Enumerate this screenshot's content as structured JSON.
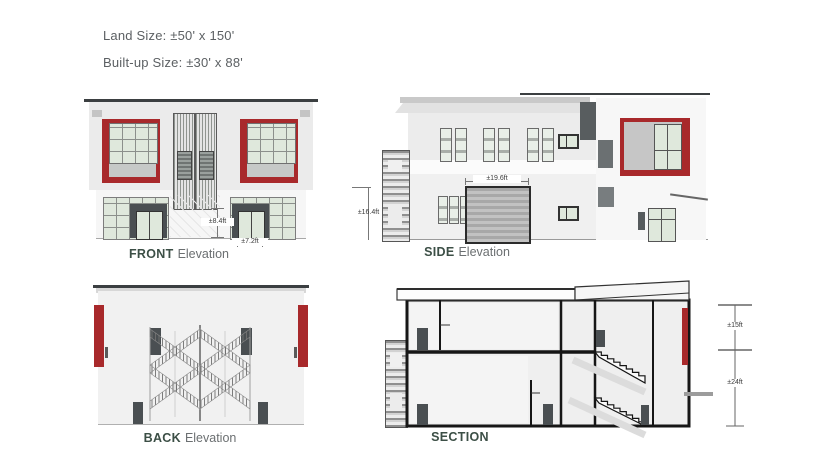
{
  "info": {
    "land_size": "Land Size: ±50' x 150'",
    "built_up_size": "Built-up Size: ±30' x 88'"
  },
  "drawings": {
    "front": {
      "name": "FRONT",
      "type": "Elevation",
      "dims": {
        "door_height": "±8.4ft",
        "door_width": "±7.2ft"
      }
    },
    "side": {
      "name": "SIDE",
      "type": "Elevation",
      "dims": {
        "height": "±16.4ft",
        "garage_width": "±19.6ft"
      }
    },
    "back": {
      "name": "BACK",
      "type": "Elevation"
    },
    "section": {
      "name": "SECTION",
      "dims": {
        "upper_floor": "±15ft",
        "lower_floor": "±24ft"
      }
    }
  },
  "colors": {
    "accent_red": "#a8292b",
    "label_dark": "#3c4f46",
    "text_gray": "#6b6f71",
    "glass": "#dfe8dc",
    "roof_dark": "#3b3f41",
    "door_dark": "#4a4f52"
  }
}
